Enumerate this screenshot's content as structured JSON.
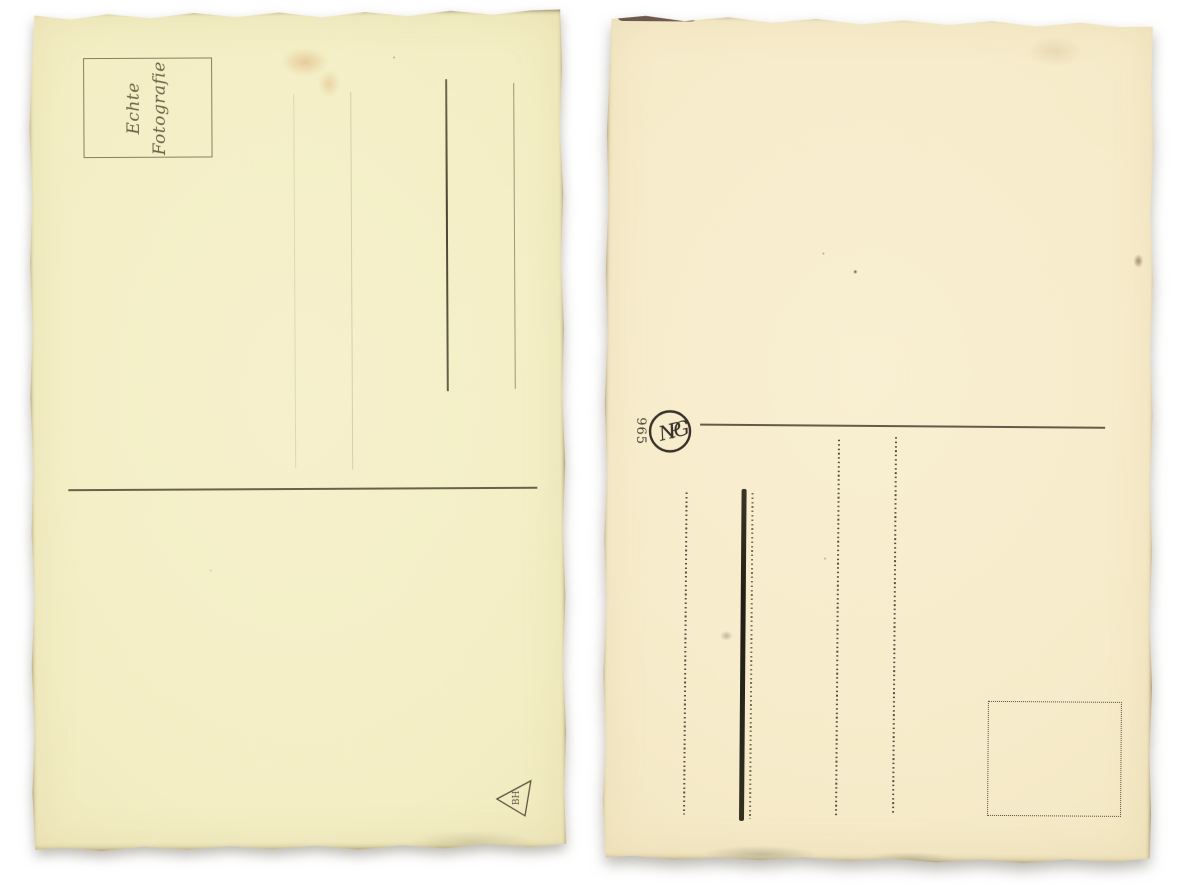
{
  "scene": {
    "description": "Backs of two blank vintage real-photo postcards scanned side by side on a white background",
    "background_color": "#ffffff"
  },
  "left_postcard": {
    "paper_color": "#f3eec5",
    "ink_color": "#5f5440",
    "stamp_box": {
      "line1": "Echte",
      "line2": "Fotografie"
    },
    "printer_mark_text": "BH"
  },
  "right_postcard": {
    "paper_color": "#f7ebca",
    "ink_color": "#38312a",
    "monogram_letters": "NPG",
    "series_number": "965"
  }
}
